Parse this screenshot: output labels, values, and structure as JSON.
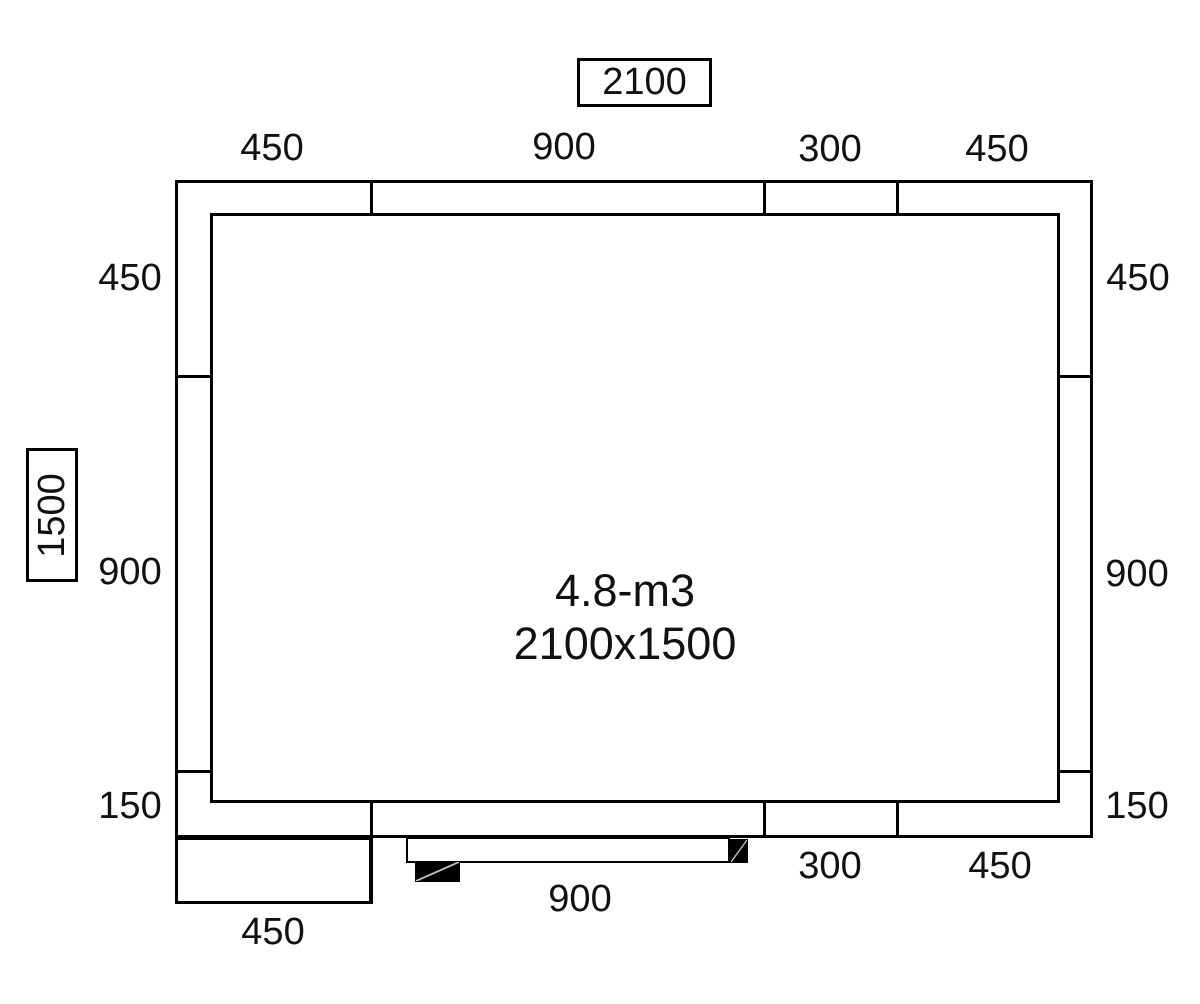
{
  "figure": {
    "kind": "cold-room-floor-plan",
    "room": {
      "volume_label": "4.8-m3",
      "size_label": "2100x1500"
    },
    "overall": {
      "width": "2100",
      "depth": "1500"
    },
    "panels": {
      "top": [
        "450",
        "900",
        "300",
        "450"
      ],
      "left": [
        "450",
        "900",
        "150"
      ],
      "right": [
        "450",
        "900",
        "150"
      ],
      "bottom": [
        "450",
        "900",
        "300",
        "450"
      ]
    },
    "colors": {
      "line": "#000000",
      "background": "#ffffff",
      "door_hardware": "#000000"
    }
  }
}
